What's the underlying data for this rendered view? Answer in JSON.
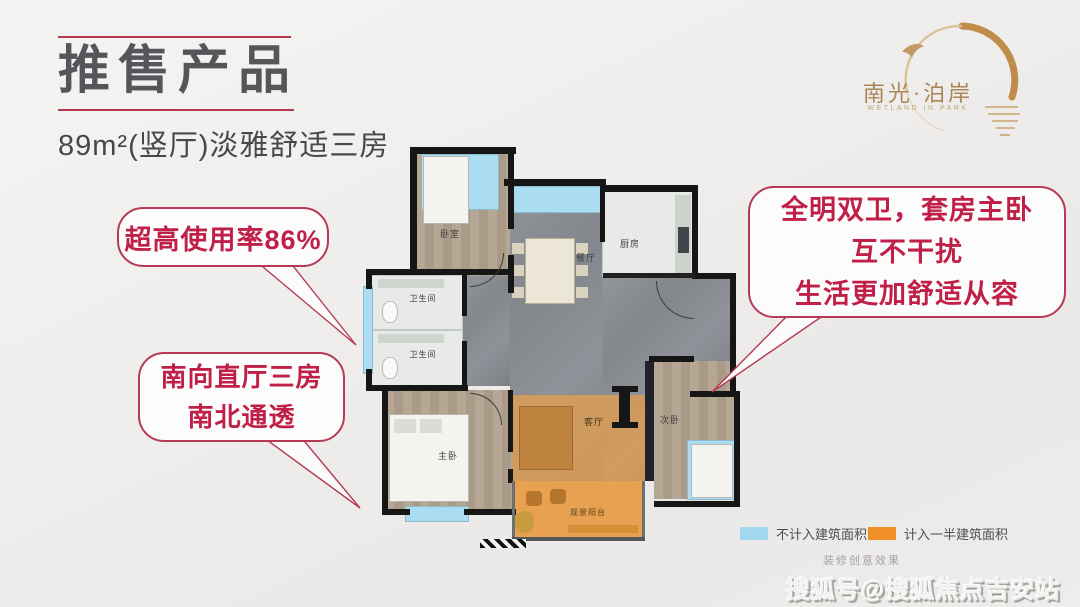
{
  "header": {
    "title": "推售产品",
    "subtitle": "89m²(竖厅)淡雅舒适三房",
    "accent_color": "#b23a4a",
    "title_color": "#57555a"
  },
  "logo": {
    "name": "南光·泊岸",
    "subtitle": "WETLAND IN PARK",
    "color": "#ac8557"
  },
  "callouts": {
    "style": {
      "border_color": "#b43a56",
      "text_color": "#c02048"
    },
    "items": [
      {
        "lines": [
          "超高使用率86%"
        ]
      },
      {
        "lines": [
          "南向直厅三房",
          "南北通透"
        ]
      },
      {
        "lines": [
          "全明双卫，套房主卧",
          "互不干扰",
          "生活更加舒适从容"
        ]
      }
    ]
  },
  "floorplan": {
    "rooms": [
      {
        "label": "卧室"
      },
      {
        "label": "餐厅"
      },
      {
        "label": "厨房"
      },
      {
        "label": "卫生间"
      },
      {
        "label": "卫生间"
      },
      {
        "label": "主卧"
      },
      {
        "label": "客厅"
      },
      {
        "label": "次卧"
      },
      {
        "label": "观景阳台"
      }
    ],
    "colors": {
      "wall": "#161616",
      "marble_floor": "#8a8e94",
      "wood_floor": "#b0a18e",
      "window_blue": "#aadcf2",
      "half_area_orange": "#e8a254"
    }
  },
  "legend": {
    "items": [
      {
        "label": "不计入建筑面积",
        "color": "#a2d7f0"
      },
      {
        "label": "计入一半建筑面积",
        "color": "#f08f28"
      }
    ]
  },
  "footnote": "装修创意效果",
  "watermark": "搜狐号@搜狐焦点吉安站"
}
